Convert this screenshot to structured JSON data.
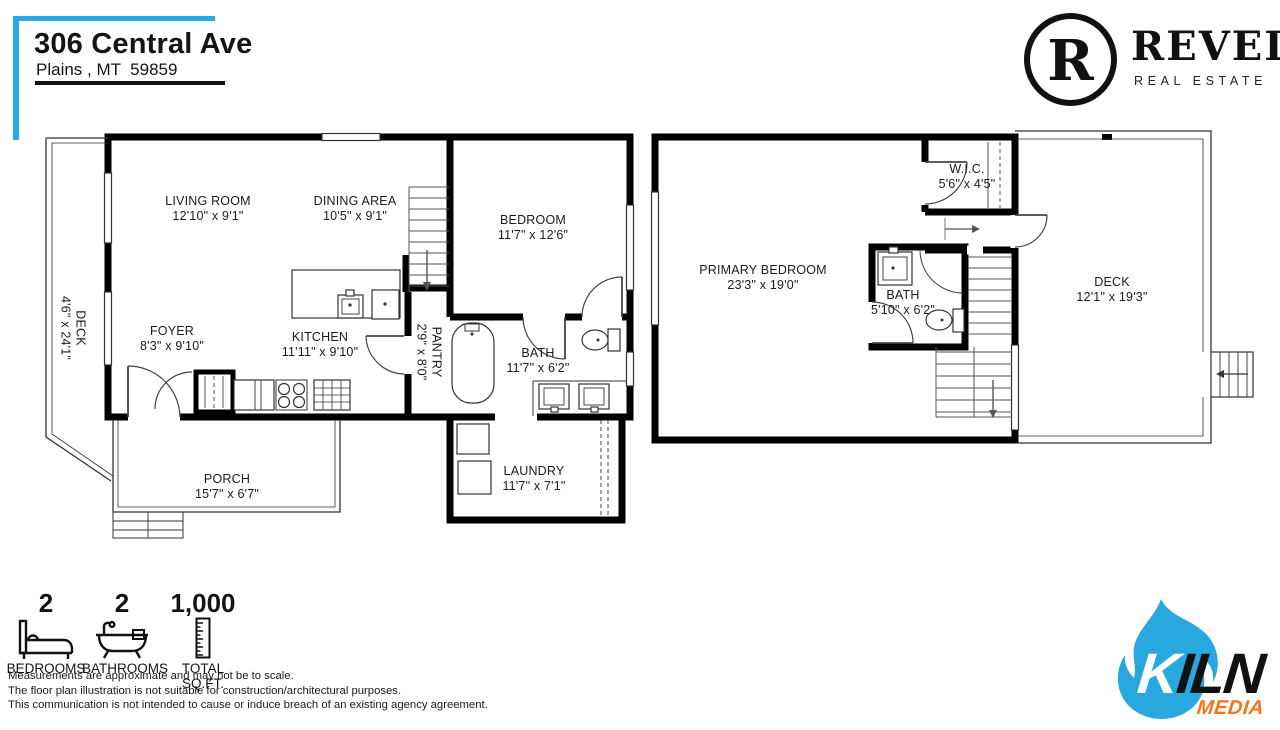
{
  "header": {
    "address_line1": "306 Central Ave",
    "address_line2": "Plains , MT  59859"
  },
  "revel_brand": {
    "monogram": "R",
    "name": "REVEL",
    "tagline": "REAL ESTATE"
  },
  "floor1": {
    "living_room": {
      "name": "LIVING ROOM",
      "dims": "12'10\" x 9'1\""
    },
    "dining_area": {
      "name": "DINING AREA",
      "dims": "10'5\" x 9'1\""
    },
    "bedroom": {
      "name": "BEDROOM",
      "dims": "11'7\" x 12'6\""
    },
    "foyer": {
      "name": "FOYER",
      "dims": "8'3\" x 9'10\""
    },
    "kitchen": {
      "name": "KITCHEN",
      "dims": "11'11\" x 9'10\""
    },
    "pantry": {
      "name": "PANTRY",
      "dims": "2'9\" x 8'0\""
    },
    "bath": {
      "name": "BATH",
      "dims": "11'7\" x 6'2\""
    },
    "laundry": {
      "name": "LAUNDRY",
      "dims": "11'7\" x 7'1\""
    },
    "porch": {
      "name": "PORCH",
      "dims": "15'7\" x 6'7\""
    },
    "deck": {
      "name": "DECK",
      "dims": "4'6\" x 24'1\""
    }
  },
  "floor2": {
    "primary_bedroom": {
      "name": "PRIMARY BEDROOM",
      "dims": "23'3\" x 19'0\""
    },
    "wic": {
      "name": "W.I.C.",
      "dims": "5'6\" x 4'5\""
    },
    "bath": {
      "name": "BATH",
      "dims": "5'10\" x 6'2\""
    },
    "deck": {
      "name": "DECK",
      "dims": "12'1\" x 19'3\""
    }
  },
  "stats": {
    "bedrooms": {
      "value": "2",
      "label": "BEDROOMS"
    },
    "bathrooms": {
      "value": "2",
      "label": "BATHROOMS"
    },
    "total_sqft": {
      "value": "1,000",
      "label": "TOTAL SQ.FT."
    }
  },
  "disclaimers": [
    "Measurements are approximate and may not be to scale.",
    "The floor plan illustration is not suitable for construction/architectural purposes.",
    "This communication is not intended to cause or induce breach of an existing agency agreement."
  ],
  "kiln_brand": {
    "k": "K",
    "iln": "ILN",
    "media": "MEDIA"
  },
  "colors": {
    "accent_blue": "#29A9E1",
    "flame_blue": "#29A8E0",
    "media_orange": "#F4741B",
    "line_black": "#000000"
  }
}
